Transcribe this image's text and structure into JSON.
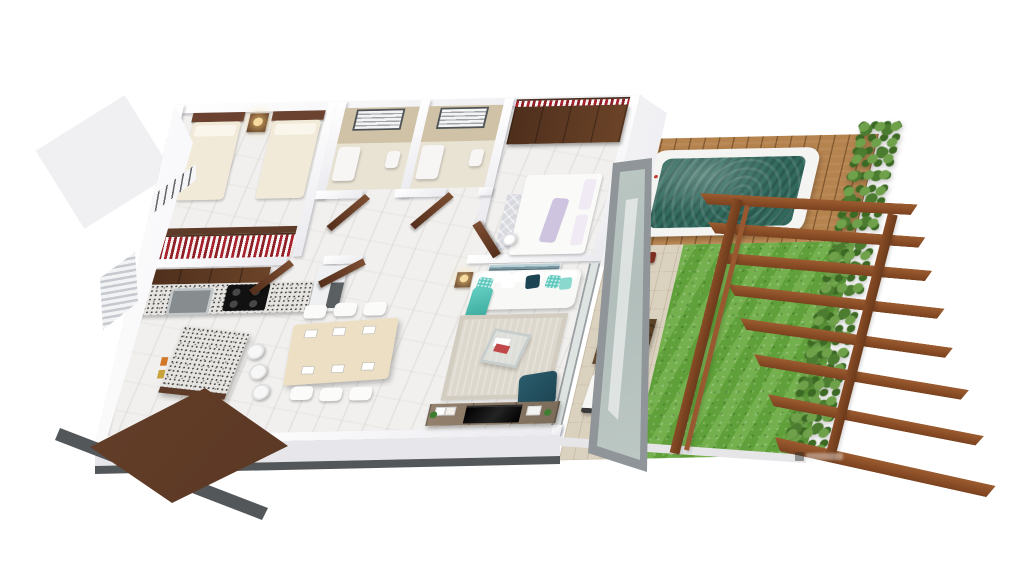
{
  "scene": {
    "type": "3d-floor-plan-render",
    "view": "isometric dollhouse cutaway, white background",
    "rooms": [
      {
        "name": "bedroom-2",
        "furniture": [
          "twin-bed",
          "twin-bed",
          "nightstand",
          "table-lamp",
          "open-closet-red-white-clothes",
          "louver-window",
          "railing-window"
        ]
      },
      {
        "name": "bathroom-1",
        "features": [
          "mosaic-feature-wall",
          "louver-window",
          "tub",
          "basin"
        ]
      },
      {
        "name": "bathroom-2",
        "features": [
          "mosaic-feature-wall",
          "louver-window",
          "tub",
          "basin"
        ]
      },
      {
        "name": "master-bedroom",
        "furniture": [
          "wardrobe-dark-wood",
          "clothes-rail",
          "double-bed",
          "patterned-rug",
          "arc-floor-lamp"
        ]
      },
      {
        "name": "hallway",
        "features": [
          "open-wood-doors"
        ]
      },
      {
        "name": "kitchen",
        "furniture": [
          "upper-cabinets",
          "granite-counter",
          "steel-sink",
          "gas-hob-4-burner",
          "fridge",
          "breakfast-island",
          "bar-stools",
          "mini-artworks"
        ]
      },
      {
        "name": "dining-area",
        "furniture": [
          "light-wood-table",
          "six-white-chairs",
          "place-settings"
        ]
      },
      {
        "name": "living-room",
        "furniture": [
          "white-sofa",
          "aqua-pillows",
          "teal-pillow",
          "aqua-throw",
          "seascape-wall-art",
          "side-table-lamp",
          "beige-rug",
          "glass-coffee-table",
          "magazines",
          "dark-teal-armchair",
          "tv-console",
          "flat-tv",
          "vase"
        ]
      },
      {
        "name": "entry",
        "features": [
          "open-entry-door"
        ]
      }
    ],
    "outdoor": [
      {
        "name": "wood-deck"
      },
      {
        "name": "jacuzzi",
        "water": "teal",
        "rim": "white"
      },
      {
        "name": "patio",
        "furniture": [
          "lounge-chair",
          "lounge-chair",
          "square-wood-table",
          "red-planter",
          "vase-dried-flowers"
        ]
      },
      {
        "name": "lawn"
      },
      {
        "name": "hedge-row"
      },
      {
        "name": "pergola",
        "beams": 8,
        "rails": 3
      }
    ]
  },
  "watermark": {
    "present": true,
    "legible": false,
    "position": "bottom-right-on-lawn"
  },
  "colors": {
    "wall": "#f6f6f8",
    "wallShade": "#e3e3e8",
    "floor": "#f1f0ee",
    "woodDark": "#6b4328",
    "door": "#6a4530",
    "granite": "#e6e4e0",
    "tile": "#cfc2a6",
    "water": "#31695d",
    "deck": "#b5834e",
    "grass": "#69a93f",
    "hedge": "#4c7c2f",
    "pergola": "#7b421f",
    "sofa": "#f8f8f7",
    "aqua": "#5fc9bd",
    "tealDark": "#1d4452",
    "rug": "#ddd8cd",
    "console": "#8a7a6a",
    "tv": "#0b0b0b",
    "tableWood": "#ecdfc3",
    "stone": "#dbd1bf",
    "stripeRed": "#a8232d",
    "frameGray": "#8f9598",
    "slab": "#54575a",
    "lampGlow": "#f7dca0"
  }
}
